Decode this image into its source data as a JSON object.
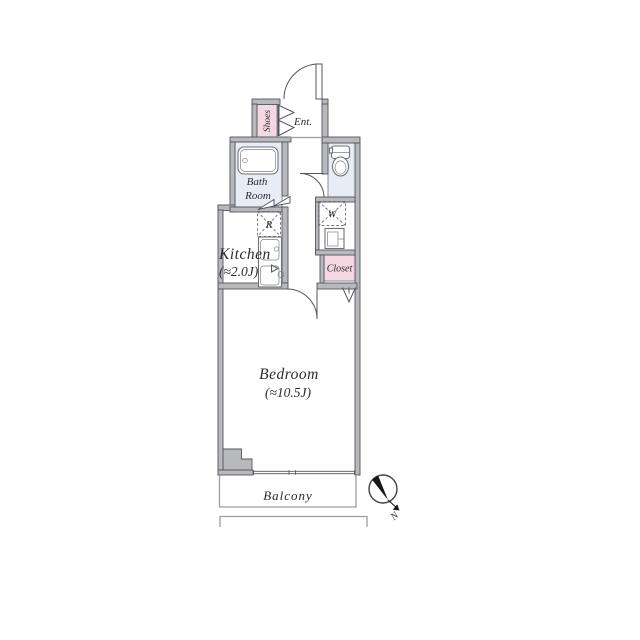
{
  "title": "Studio apartment floor plan",
  "palette": {
    "wall_fill": "#b7b9bd",
    "wall_stroke": "#55575d",
    "wet_room_fill": "#e8ecf4",
    "storage_fill": "#f6d8e2",
    "line_dark": "#55575d",
    "line_light": "#9a9da3",
    "text": "#2b2b2e",
    "needle": "#171717"
  },
  "rooms": {
    "shoes": {
      "label": "Shoes"
    },
    "entrance": {
      "label": "Ent."
    },
    "bathroom": {
      "label_line1": "Bath",
      "label_line2": "Room"
    },
    "toilet": {
      "label": ""
    },
    "kitchen": {
      "label": "Kitchen",
      "size": "(≈2.0J)"
    },
    "refrigerator_space": {
      "label": "R"
    },
    "washer_space": {
      "label": "W"
    },
    "closet": {
      "label": "Closet"
    },
    "bedroom": {
      "label": "Bedroom",
      "size": "(≈10.5J)"
    },
    "balcony": {
      "label": "Balcony"
    }
  },
  "compass": {
    "north_label": "N"
  }
}
